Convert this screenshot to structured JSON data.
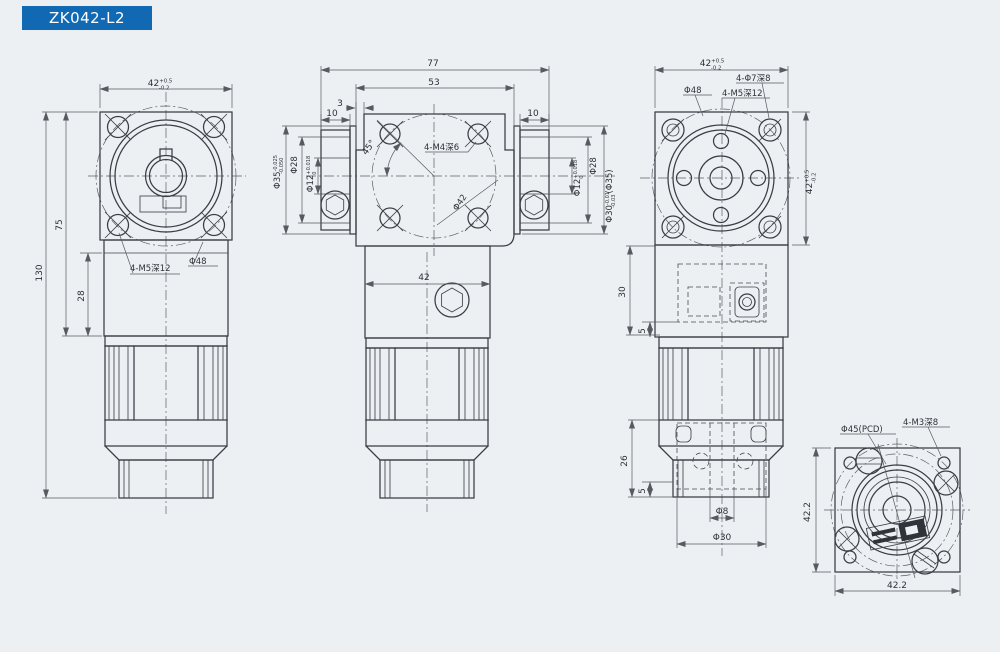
{
  "title_bar": {
    "label": "ZK042-L2"
  },
  "colors": {
    "banner": "#1169b4",
    "background": "#edf0f3",
    "line": "#3a3e44"
  },
  "labels": [
    {
      "name": "dim-a-42-top",
      "text": "42",
      "sup": "+0.5",
      "sub": "-0.2",
      "x": 160,
      "y": 86
    },
    {
      "name": "dim-a-75",
      "text": "75",
      "x": 62,
      "y": 225,
      "rot": -90
    },
    {
      "name": "dim-a-130",
      "text": "130",
      "x": 42,
      "y": 273,
      "rot": -90
    },
    {
      "name": "dim-a-28",
      "text": "28",
      "x": 84,
      "y": 296,
      "rot": -90
    },
    {
      "name": "label-a-4m5",
      "text": "4-M5深12",
      "x": 130,
      "y": 271,
      "anchor": "start",
      "size": 8.5
    },
    {
      "name": "label-a-phi48",
      "text": "Φ48",
      "x": 189,
      "y": 264,
      "anchor": "start",
      "size": 8.5
    },
    {
      "name": "dim-b-77",
      "text": "77",
      "x": 433,
      "y": 66
    },
    {
      "name": "dim-b-53",
      "text": "53",
      "x": 434,
      "y": 85
    },
    {
      "name": "dim-b-3",
      "text": "3",
      "x": 340,
      "y": 106
    },
    {
      "name": "dim-b-10-left",
      "text": "10",
      "x": 332,
      "y": 116
    },
    {
      "name": "dim-b-10-right",
      "text": "10",
      "x": 533,
      "y": 116
    },
    {
      "name": "dim-b-45",
      "text": "45°",
      "x": 371,
      "y": 149,
      "rot": -55
    },
    {
      "name": "label-b-4m4",
      "text": "4-M4深6",
      "x": 424,
      "y": 150,
      "anchor": "start",
      "size": 8.5
    },
    {
      "name": "label-b-phi42",
      "text": "Φ42",
      "x": 462,
      "y": 204,
      "rot": -55,
      "size": 8.5
    },
    {
      "name": "dim-b-42",
      "text": "42",
      "x": 424,
      "y": 280
    },
    {
      "name": "dim-b-phi35-left",
      "text": "Φ35",
      "sup": "-0.025",
      "sub": "-0.050",
      "x": 280,
      "y": 172,
      "rot": -90,
      "size": 8.5
    },
    {
      "name": "dim-b-phi28-left",
      "text": "Φ28",
      "x": 297,
      "y": 165,
      "rot": -90,
      "size": 8.5
    },
    {
      "name": "dim-b-phi12-left",
      "text": "Φ12",
      "sup": "+0.018",
      "sub": "0",
      "x": 313,
      "y": 174,
      "rot": -90,
      "size": 8.5
    },
    {
      "name": "dim-b-phi12-right",
      "text": "Φ12",
      "sup": "+0.018",
      "sub": "0",
      "x": 580,
      "y": 178,
      "rot": -90,
      "size": 8.5
    },
    {
      "name": "dim-b-phi28-right",
      "text": "Φ28",
      "x": 596,
      "y": 166,
      "rot": -90,
      "size": 8.5
    },
    {
      "name": "dim-b-phi30-right",
      "text": "Φ30",
      "sup": "-0.01",
      "sub": "-0.03",
      "post": "(Φ35)",
      "x": 612,
      "y": 196,
      "rot": -90,
      "size": 8.5
    },
    {
      "name": "dim-c-42-top",
      "text": "42",
      "sup": "+0.5",
      "sub": "-0.2",
      "x": 712,
      "y": 66
    },
    {
      "name": "label-c-4phi7",
      "text": "4-Φ7深8",
      "x": 736,
      "y": 81,
      "anchor": "start",
      "size": 8.5
    },
    {
      "name": "label-c-4m5",
      "text": "4-M5深12",
      "x": 722,
      "y": 96,
      "anchor": "start",
      "size": 8.5
    },
    {
      "name": "label-c-phi48",
      "text": "Φ48",
      "x": 684,
      "y": 93,
      "anchor": "start",
      "size": 8.5
    },
    {
      "name": "dim-c-42-right",
      "text": "42",
      "sup": "+0.5",
      "sub": "-0.2",
      "x": 812,
      "y": 182,
      "rot": -90
    },
    {
      "name": "dim-c-30",
      "text": "30",
      "x": 625,
      "y": 292,
      "rot": -90
    },
    {
      "name": "dim-c-5-upper",
      "text": "5",
      "x": 645,
      "y": 331,
      "rot": -90
    },
    {
      "name": "dim-c-26",
      "text": "26",
      "x": 627,
      "y": 461,
      "rot": -90
    },
    {
      "name": "dim-c-5-lower",
      "text": "5",
      "x": 645,
      "y": 491,
      "rot": -90
    },
    {
      "name": "dim-c-phi8",
      "text": "Φ8",
      "x": 722,
      "y": 514
    },
    {
      "name": "dim-c-phi30",
      "text": "Φ30",
      "x": 722,
      "y": 540
    },
    {
      "name": "label-d-phi45",
      "text": "Φ45(PCD)",
      "x": 841,
      "y": 432,
      "anchor": "start",
      "size": 8.5
    },
    {
      "name": "label-d-4m3",
      "text": "4-M3深8",
      "x": 903,
      "y": 425,
      "anchor": "start",
      "size": 8.5
    },
    {
      "name": "dim-d-422-left",
      "text": "42.2",
      "x": 810,
      "y": 512,
      "rot": -90
    },
    {
      "name": "dim-d-422-bottom",
      "text": "42.2",
      "x": 897,
      "y": 588
    }
  ]
}
